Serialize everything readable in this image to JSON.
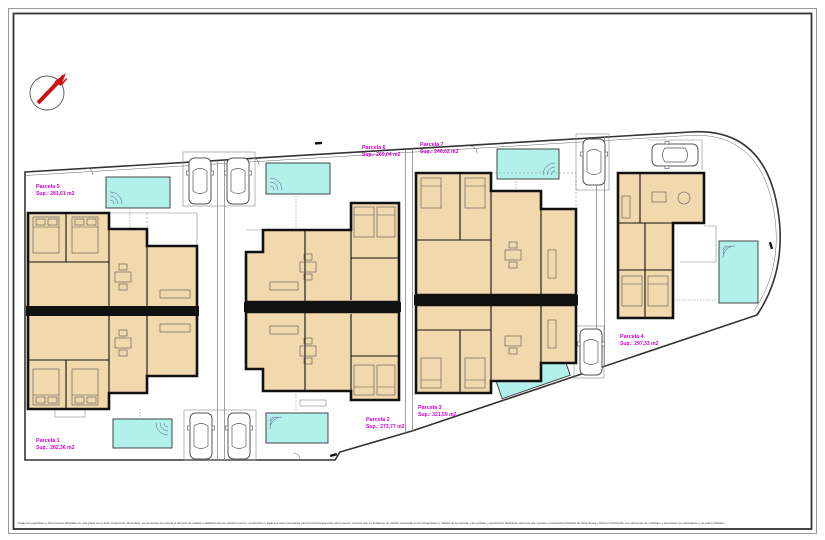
{
  "plan": {
    "north_label": "N",
    "parcels": [
      {
        "name": "Parcela 1",
        "area": "Sup.: 282,36 m2"
      },
      {
        "name": "Parcela 2",
        "area": "Sup.: 273,77 m2"
      },
      {
        "name": "Parcela 3",
        "area": "Sup.: 321,59 m2"
      },
      {
        "name": "Parcela 4",
        "area": "Sup.: 297,33 m2"
      },
      {
        "name": "Parcela 5",
        "area": "Sup.: 281,61 m2"
      },
      {
        "name": "Parcela 6",
        "area": "Sup.: 269,04 m2"
      },
      {
        "name": "Parcela 7",
        "area": "Sup.: 246,02 m2"
      }
    ],
    "disclaimer": "Todas las superficies y dimensiones dibujadas en este plano son a titulo meramente informativo. La promotora se reserva el derecho de realizar modificaciones de caracter tecnico, constructivo o legal que sean necesarias para la correcta ejecucion del proyecto, siempre que no impliquen un cambio sustancial en la configuracion o calidad de la vivienda. Las medidas y descripcion definitivas seran las que constan en la Escritura Publica de Obra Nueva y Division Horizontal. Los elementos de mobiliario y decoracion son ilustrativos y no estan incluidos.",
    "colors": {
      "parcel_label": "#cc00cc",
      "north_arrow": "#cc1111",
      "pool_fill": "#b2f0ec",
      "room_fill": "#f2d8ad",
      "wall": "#111111"
    }
  }
}
